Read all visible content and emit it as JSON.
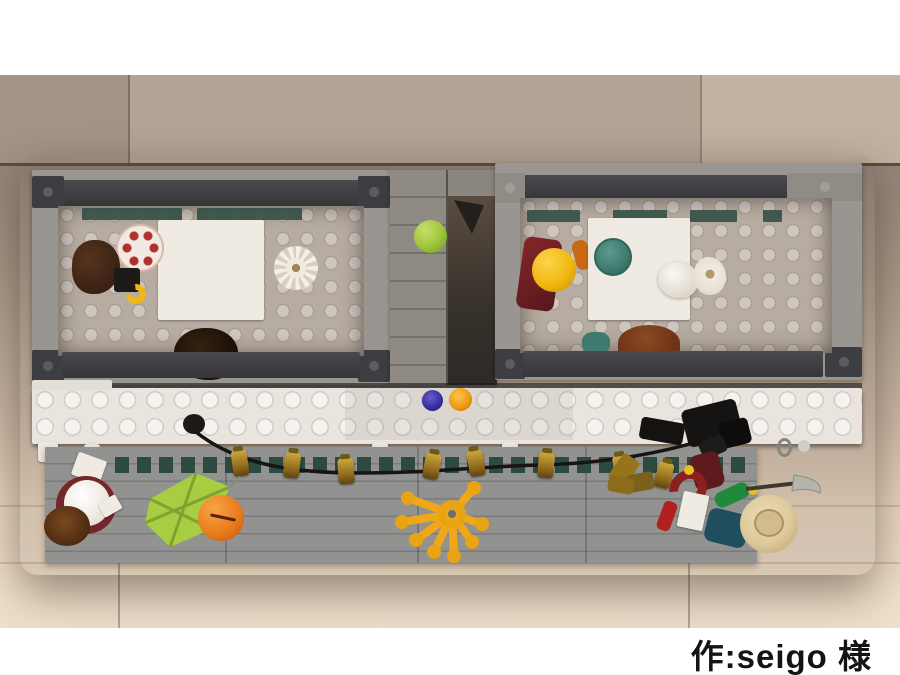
{
  "caption": {
    "text": "作:seigo 様"
  },
  "palette": {
    "wood_top_plank": "#b0a193",
    "wood_mid": "#a2948a",
    "wood_bottom": "#eedec9",
    "wall_light": "#999590",
    "wall_dark": "#3f4043",
    "room_floor": "#b7aca1",
    "white_brick": "#e9e5de",
    "base_wall": "#8f8f8d",
    "garland_green": "#2c4a3f",
    "lantern_gold": "#b08428",
    "umbrella_lime": "#a8cc42",
    "pumpkin_orange": "#e8791a",
    "octopus_yellow": "#f0a818",
    "apple_lime": "#9dc43a",
    "plate_teal": "#3e7a6d",
    "stud_blue": "#3a2f9a",
    "stud_orange": "#f09a12",
    "hat_tan": "#ddc89b",
    "hair_dark": "#3a2114",
    "hair_red": "#6e3418",
    "minifig_yellow": "#f2b811",
    "dark_red": "#7c2528",
    "caption_color": "#141414"
  }
}
